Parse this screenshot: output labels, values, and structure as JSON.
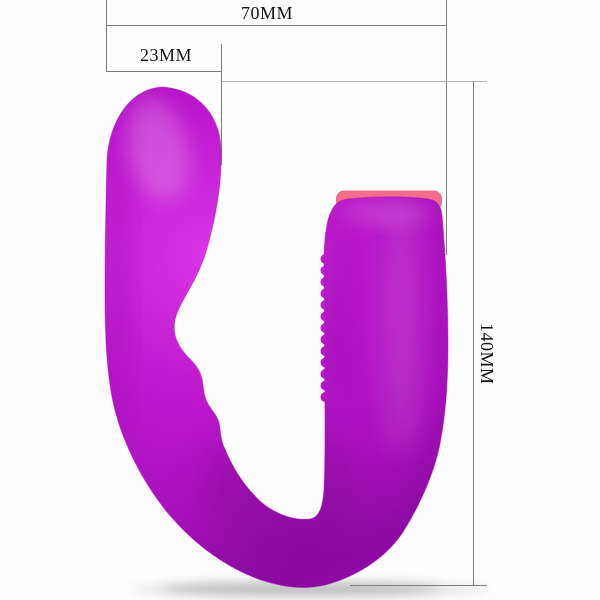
{
  "product_diagram": {
    "labels": {
      "total_width": "70MM",
      "head_width": "23MM",
      "total_height": "140MM"
    },
    "colors": {
      "body_light": "#d935e6",
      "body_mid": "#bc17cc",
      "body_deep": "#a811bb",
      "body_dark": "#8e0aa4",
      "tip_accent": "#f26d8d",
      "dimension_line": "#7d7d7d",
      "dimension_line_light": "#b2b2b2",
      "label_text": "#141414",
      "background": "#fdfdfe",
      "shadow": "#8a8a8a"
    }
  }
}
